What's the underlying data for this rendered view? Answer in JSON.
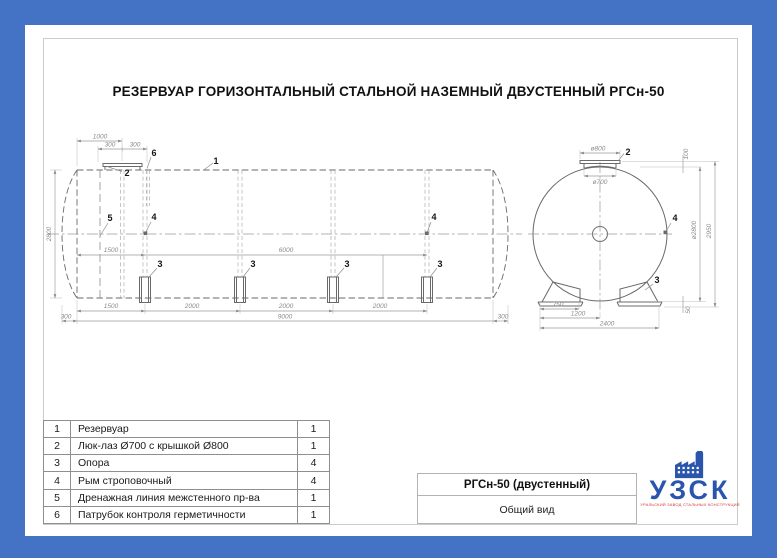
{
  "doc": {
    "title": "РЕЗЕРВУАР ГОРИЗОНТАЛЬНЫЙ СТАЛЬНОЙ НАЗЕМНЫЙ ДВУСТЕННЫЙ РГСн-50"
  },
  "side_view": {
    "dim_1000": "1000",
    "dim_300": "300",
    "dim_2800": "2800",
    "dim_1500": "1500",
    "dim_6000": "6000",
    "dim_2000": "2000",
    "dim_9000": "9000",
    "callout_1": "1",
    "callout_2": "2",
    "callout_3": "3",
    "callout_4": "4",
    "callout_5": "5",
    "callout_6": "6"
  },
  "end_view": {
    "dim_d800": "ø800",
    "dim_d700": "ø700",
    "dim_100": "100",
    "dim_d2800": "ø2800",
    "dim_2950": "2950",
    "dim_50": "50",
    "dim_750": "750",
    "dim_1200": "1200",
    "dim_2400": "2400",
    "callout_2": "2",
    "callout_3": "3",
    "callout_4": "4"
  },
  "parts_table": {
    "rows": [
      {
        "num": "1",
        "name": "Резервуар",
        "qty": "1"
      },
      {
        "num": "2",
        "name": "Люк-лаз Ø700 с крышкой Ø800",
        "qty": "1"
      },
      {
        "num": "3",
        "name": "Опора",
        "qty": "4"
      },
      {
        "num": "4",
        "name": "Рым строповочный",
        "qty": "4"
      },
      {
        "num": "5",
        "name": "Дренажная линия межстенного пр-ва",
        "qty": "1"
      },
      {
        "num": "6",
        "name": "Патрубок контроля герметичности",
        "qty": "1"
      }
    ]
  },
  "title_block": {
    "model": "РГСн-50 (двустенный)",
    "view_name": "Общий вид"
  },
  "logo": {
    "name": "УЗСК",
    "tagline": "УРАЛЬСКИЙ ЗАВОД СТАЛЬНЫХ КОНСТРУКЦИЙ",
    "blue": "#2a55ad",
    "red": "#cf3a36"
  },
  "colors": {
    "background": "#4472c4",
    "paper": "#ffffff"
  }
}
